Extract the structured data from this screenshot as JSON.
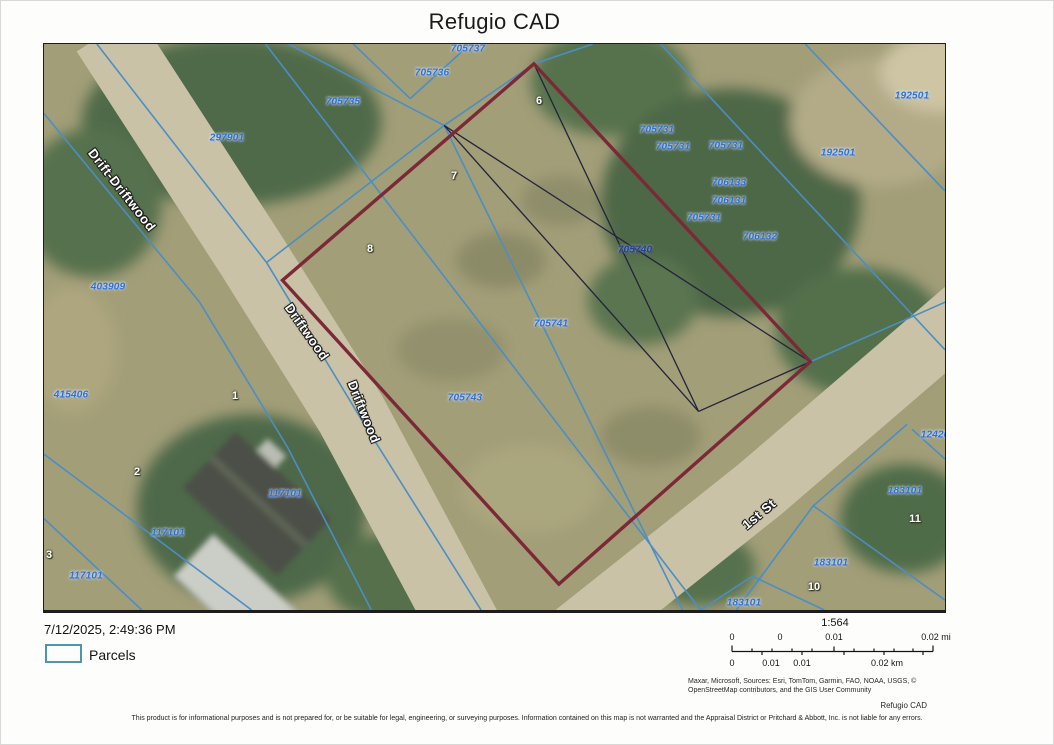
{
  "title": "Refugio CAD",
  "map": {
    "colors": {
      "terrain": "#a29e78",
      "road": "#c9c2a7",
      "parcel_line": "#4b8ec5",
      "survey_line": "#23233a",
      "highlight": "#7c2836",
      "label_blue": "#2e6fd6"
    },
    "highlight_parcel": {
      "points": [
        [
          491,
          20
        ],
        [
          768,
          320
        ],
        [
          516,
          544
        ],
        [
          239,
          238
        ]
      ]
    },
    "survey_lines": [
      [
        [
          491,
          20
        ],
        [
          656,
          370
        ]
      ],
      [
        [
          401,
          82
        ],
        [
          768,
          320
        ]
      ],
      [
        [
          401,
          82
        ],
        [
          656,
          370
        ]
      ],
      [
        [
          768,
          320
        ],
        [
          656,
          370
        ]
      ]
    ],
    "roads": [
      {
        "name": "Driftwood",
        "points": [
          [
            63,
            -12
          ],
          [
            208,
            213
          ],
          [
            308,
            373
          ],
          [
            428,
            598
          ]
        ],
        "width": 72
      },
      {
        "name": "1st St",
        "points": [
          [
            938,
            258
          ],
          [
            718,
            448
          ],
          [
            518,
            608
          ]
        ],
        "width": 66
      }
    ],
    "parcel_lines": [
      [
        [
          53,
          0
        ],
        [
          223,
          220
        ]
      ],
      [
        [
          223,
          220
        ],
        [
          401,
          82
        ]
      ],
      [
        [
          223,
          220
        ],
        [
          318,
          378
        ],
        [
          438,
          570
        ]
      ],
      [
        [
          245,
          0
        ],
        [
          401,
          82
        ]
      ],
      [
        [
          401,
          82
        ],
        [
          491,
          20
        ]
      ],
      [
        [
          310,
          0
        ],
        [
          367,
          55
        ]
      ],
      [
        [
          367,
          55
        ],
        [
          425,
          2
        ]
      ],
      [
        [
          222,
          0
        ],
        [
          658,
          570
        ]
      ],
      [
        [
          401,
          82
        ],
        [
          640,
          570
        ]
      ],
      [
        [
          618,
          0
        ],
        [
          903,
          308
        ]
      ],
      [
        [
          763,
          0
        ],
        [
          903,
          148
        ]
      ],
      [
        [
          768,
          320
        ],
        [
          903,
          260
        ]
      ],
      [
        [
          865,
          383
        ],
        [
          771,
          465
        ],
        [
          694,
          570
        ]
      ],
      [
        [
          771,
          465
        ],
        [
          903,
          560
        ]
      ],
      [
        [
          870,
          388
        ],
        [
          903,
          418
        ]
      ],
      [
        [
          658,
          570
        ],
        [
          710,
          536
        ],
        [
          782,
          570
        ]
      ],
      [
        [
          0,
          413
        ],
        [
          208,
          570
        ]
      ],
      [
        [
          0,
          478
        ],
        [
          98,
          570
        ]
      ],
      [
        [
          0,
          70
        ],
        [
          156,
          260
        ],
        [
          244,
          406
        ],
        [
          328,
          570
        ]
      ],
      [
        [
          491,
          20
        ],
        [
          550,
          0
        ]
      ]
    ],
    "parcel_labels": [
      {
        "text": "705737",
        "x": 424,
        "y": 5
      },
      {
        "text": "705736",
        "x": 388,
        "y": 29
      },
      {
        "text": "705735",
        "x": 299,
        "y": 58
      },
      {
        "text": "297901",
        "x": 183,
        "y": 94
      },
      {
        "text": "192501",
        "x": 868,
        "y": 52
      },
      {
        "text": "192501",
        "x": 794,
        "y": 109
      },
      {
        "text": "705731",
        "x": 613,
        "y": 86
      },
      {
        "text": "705731",
        "x": 629,
        "y": 103
      },
      {
        "text": "705731",
        "x": 682,
        "y": 102
      },
      {
        "text": "706133",
        "x": 685,
        "y": 139
      },
      {
        "text": "706131",
        "x": 685,
        "y": 157
      },
      {
        "text": "705731",
        "x": 660,
        "y": 174
      },
      {
        "text": "706132",
        "x": 716,
        "y": 193
      },
      {
        "text": "705740",
        "x": 591,
        "y": 206,
        "variant": "dark"
      },
      {
        "text": "705741",
        "x": 507,
        "y": 280
      },
      {
        "text": "705743",
        "x": 421,
        "y": 354
      },
      {
        "text": "403909",
        "x": 64,
        "y": 243
      },
      {
        "text": "415406",
        "x": 27,
        "y": 351
      },
      {
        "text": "117101",
        "x": 241,
        "y": 450
      },
      {
        "text": "117101",
        "x": 124,
        "y": 489
      },
      {
        "text": "117101",
        "x": 42,
        "y": 532
      },
      {
        "text": "124201",
        "x": 894,
        "y": 391
      },
      {
        "text": "183101",
        "x": 861,
        "y": 447
      },
      {
        "text": "183101",
        "x": 787,
        "y": 519
      },
      {
        "text": "183101",
        "x": 700,
        "y": 559
      }
    ],
    "lot_numbers": [
      {
        "text": "6",
        "x": 495,
        "y": 57
      },
      {
        "text": "7",
        "x": 410,
        "y": 132
      },
      {
        "text": "8",
        "x": 326,
        "y": 205
      },
      {
        "text": "1",
        "x": 191,
        "y": 352
      },
      {
        "text": "2",
        "x": 93,
        "y": 428
      },
      {
        "text": "3",
        "x": 5,
        "y": 511
      },
      {
        "text": "11",
        "x": 871,
        "y": 475
      },
      {
        "text": "10",
        "x": 770,
        "y": 543
      }
    ],
    "street_labels": [
      {
        "text": "Drift-Driftwood",
        "x": 78,
        "y": 146,
        "rot": 52
      },
      {
        "text": "Driftwood",
        "x": 263,
        "y": 288,
        "rot": 55
      },
      {
        "text": "Driftwood",
        "x": 320,
        "y": 368,
        "rot": 68
      },
      {
        "text": "1st St",
        "x": 715,
        "y": 470,
        "rot": -40
      }
    ]
  },
  "legend": {
    "label": "Parcels"
  },
  "footer": {
    "timestamp": "7/12/2025, 2:49:36 PM",
    "scale": {
      "ratio": "1:564",
      "mi_labels": [
        {
          "text": "0",
          "x": 731
        },
        {
          "text": "0",
          "x": 779
        },
        {
          "text": "0.01",
          "x": 833
        },
        {
          "text": "0.02 mi",
          "x": 935
        }
      ],
      "km_labels": [
        {
          "text": "0",
          "x": 731
        },
        {
          "text": "0.01",
          "x": 770
        },
        {
          "text": "0.01",
          "x": 801
        },
        {
          "text": "0.02 km",
          "x": 886
        }
      ]
    },
    "attribution_lines": [
      "Maxar, Microsoft, Sources: Esri, TomTom, Garmin, FAO, NOAA, USGS, ©",
      "OpenStreetMap contributors, and the GIS User Community"
    ],
    "brand": "Refugio CAD",
    "disclaimer": "This product is for informational purposes and is not prepared for, or be suitable for legal, engineering, or surveying purposes. Information contained on this map is not warranted and the Appraisal District or Pritchard & Abbott, Inc. is not liable for any errors."
  }
}
